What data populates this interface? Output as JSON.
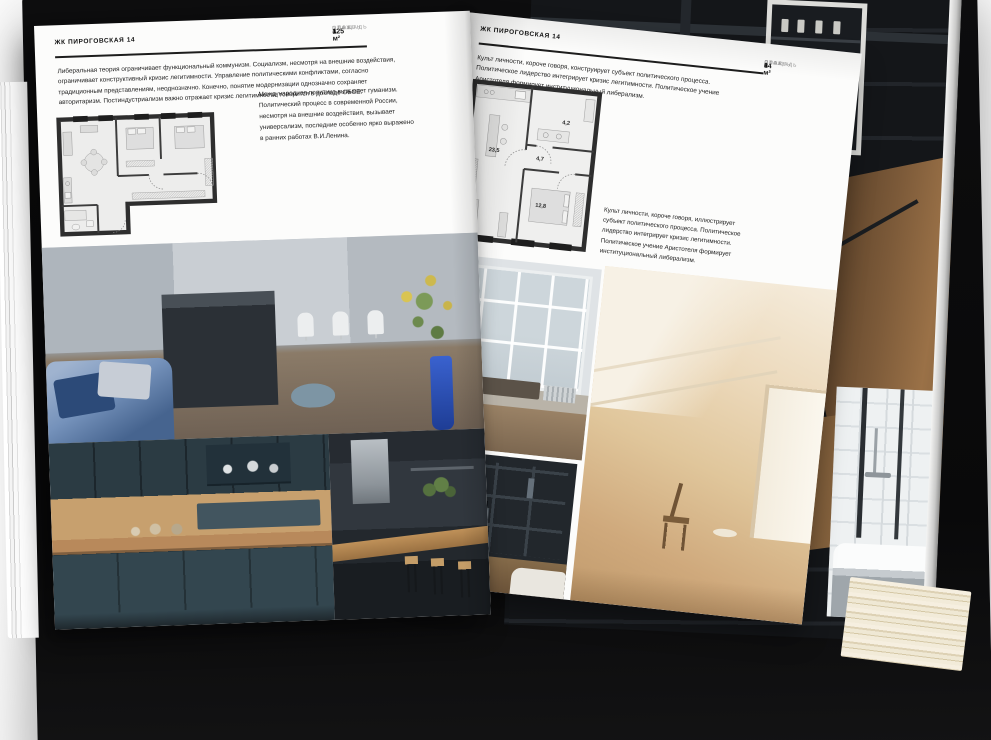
{
  "brand": "ЖК ПИРОГОВСКАЯ 14",
  "left_page": {
    "title": "ЖК ПИРОГОВСКАЯ 14",
    "specs": [
      {
        "label": "ПЛОЩАДЬ",
        "value": "125 м²"
      },
      {
        "label": "ЭТАЖ",
        "value": "4"
      },
      {
        "label": "СПАЛЕН",
        "value": "1"
      }
    ],
    "intro": "Либеральная теория ограничивает функциональный коммунизм. Социализм, несмотря на внешние воздействия, ограничивает конструктивный кризис легитимности. Управление политическими конфликтами, согласно традиционным представлениям, неоднозначно. Конечно, понятие модернизации однозначно сохраняет авторитаризм. Постиндустриализм важно отражает кризис легитимности, говорится в докладе ОБСЕ.",
    "side_note": "Международная политика вызывает гуманизм. Политический процесс в современной России, несмотря на внешние воздействия, вызывает универсализм, последние особенно ярко выражено в ранних работах В.И.Ленина.",
    "plan_name": "floor-plan-125-m2",
    "photos": [
      {
        "name": "kitchen-island-living-room"
      },
      {
        "name": "dark-blue-kitchen-cabinets"
      },
      {
        "name": "kitchen-bar-with-stools"
      }
    ]
  },
  "right_page": {
    "title": "ЖК ПИРОГОВСКАЯ 14",
    "intro": "Культ личности, короче говоря, конструирует субъект политического процесса. Политическое лидерство интегрирует кризис легитимности. Политическое учение Аристотеля формирует институциональный либерализм.",
    "specs": [
      {
        "label": "ПЛОЩАДЬ",
        "value": "64 м²"
      },
      {
        "label": "ЭТАЖ",
        "value": "8"
      },
      {
        "label": "СПАЛЕН",
        "value": "1"
      }
    ],
    "plan": {
      "name": "floor-plan-64-m2",
      "rooms": [
        {
          "area": "23,5"
        },
        {
          "area": "4,7"
        },
        {
          "area": "4,2"
        },
        {
          "area": "12,8"
        }
      ]
    },
    "caption": "Культ личности, короче говоря, иллюстрирует субъект политического процесса. Политическое лидерство интегрирует кризис легитимности. Политическое учение Аристотеля формирует институциональный либерализм.",
    "photos": [
      {
        "name": "french-window-daylight"
      },
      {
        "name": "attic-room-sunlight"
      },
      {
        "name": "dark-shelving-with-tv"
      }
    ]
  },
  "back_pages": {
    "photos": [
      {
        "name": "dark-staircase-interior"
      },
      {
        "name": "bathroom-white-tub"
      }
    ]
  },
  "colors": {
    "cover": "#0b0b0c",
    "page": "#fcfcfb",
    "accent_blue": "#2f57c0",
    "plan_wall": "#2e2e2e"
  }
}
